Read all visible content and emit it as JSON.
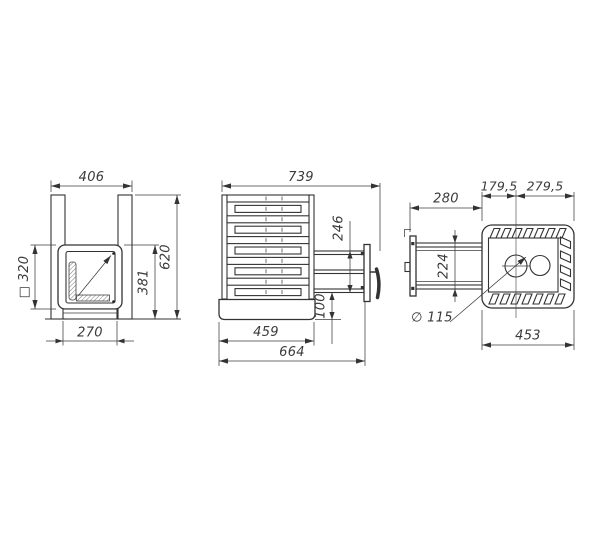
{
  "drawing": {
    "title": "stove-three-view-dimension-drawing",
    "front_view": {
      "overall_width": "406",
      "overall_height": "620",
      "firebox_front_height": "381",
      "door_square": "□ 320",
      "base_width": "270"
    },
    "side_view": {
      "overall_depth": "739",
      "tunnel_height": "246",
      "tunnel_bottom_offset": "100",
      "body_depth": "459",
      "depth_to_door": "664"
    },
    "top_view": {
      "chimney_to_front": "179,5",
      "chimney_to_back": "279,5",
      "tunnel_length": "280",
      "tunnel_width": "224",
      "chimney_diameter": "∅ 115",
      "base_depth": "453"
    }
  }
}
